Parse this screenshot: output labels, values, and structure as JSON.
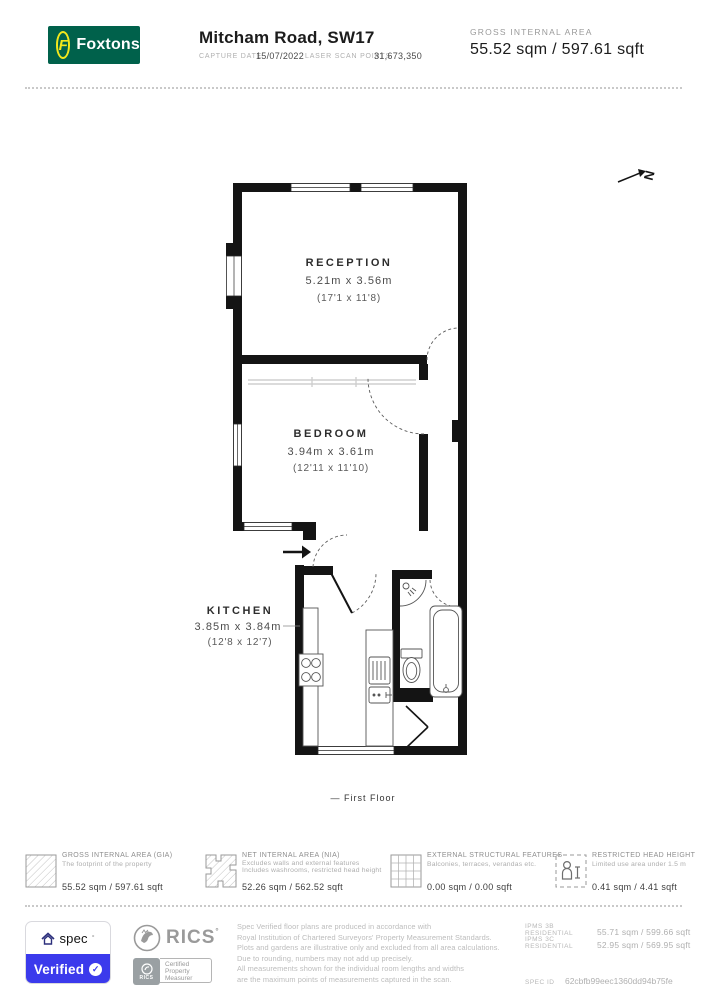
{
  "header": {
    "brand": "Foxtons",
    "brand_initial": "F",
    "title": "Mitcham Road, SW17",
    "capture_date_label": "CAPTURE DATE",
    "capture_date": "15/07/2022",
    "laser_label": "LASER SCAN POINTS",
    "laser_points": "31,673,350",
    "gia_label": "GROSS INTERNAL AREA",
    "gia_value": "55.52 sqm / 597.61 sqft"
  },
  "plan": {
    "north_label": "N",
    "rooms": [
      {
        "name": "RECEPTION",
        "metric": "5.21m x 3.56m",
        "imperial": "(17'1 x 11'8)"
      },
      {
        "name": "BEDROOM",
        "metric": "3.94m x 3.61m",
        "imperial": "(12'11 x 11'10)"
      },
      {
        "name": "KITCHEN",
        "metric": "3.85m x 3.84m",
        "imperial": "(12'8 x 12'7)"
      }
    ],
    "floor_label": "— First Floor"
  },
  "legend": {
    "items": [
      {
        "icon": "hatched-square",
        "title": "GROSS INTERNAL AREA (GIA)",
        "desc1": "The footprint of the property",
        "desc2": "",
        "value": "55.52 sqm / 597.61 sqft"
      },
      {
        "icon": "hatched-plan-shape",
        "title": "NET INTERNAL AREA (NIA)",
        "desc1": "Excludes walls and external features",
        "desc2": "Includes washrooms, restricted head height",
        "value": "52.26 sqm / 562.52 sqft"
      },
      {
        "icon": "grid-square",
        "title": "EXTERNAL STRUCTURAL FEATURES",
        "desc1": "Balconies, terraces, verandas etc.",
        "desc2": "",
        "value": "0.00 sqm / 0.00 sqft"
      },
      {
        "icon": "person-dashed-square",
        "title": "RESTRICTED HEAD HEIGHT",
        "desc1": "Limited use area under 1.5 m",
        "desc2": "",
        "value": "0.41 sqm / 4.41 sqft"
      }
    ]
  },
  "footer": {
    "spec_badge": {
      "brand": "spec",
      "status": "Verified",
      "check": "✓"
    },
    "rics": {
      "name": "RICS",
      "cert_line1": "Certified",
      "cert_line2": "Property",
      "cert_line3": "Measurer",
      "cert_small": "RICS"
    },
    "disclaimer_lines": [
      "Spec Verified floor plans are produced in accordance with",
      "Royal Institution of Chartered Surveyors' Property Measurement Standards.",
      "Plots and gardens are illustrative only and excluded from all area calculations.",
      "Due to rounding, numbers may not add up precisely.",
      "All measurements shown for the individual room lengths and widths",
      "are the maximum points of measurements captured in the scan."
    ],
    "ipms": [
      {
        "label": "IPMS 3B RESIDENTIAL",
        "value": "55.71 sqm / 599.66 sqft"
      },
      {
        "label": "IPMS 3C RESIDENTIAL",
        "value": "52.95 sqm / 569.95 sqft"
      }
    ],
    "spec_id_label": "SPEC ID",
    "spec_id": "62cbfb99eec1360dd94b75fe"
  },
  "colors": {
    "foxtons_green": "#00614B",
    "foxtons_yellow": "#F2E71C",
    "spec_blue": "#3B3AEC",
    "wall_black": "#141414",
    "muted_gray": "#9a9a9a"
  }
}
